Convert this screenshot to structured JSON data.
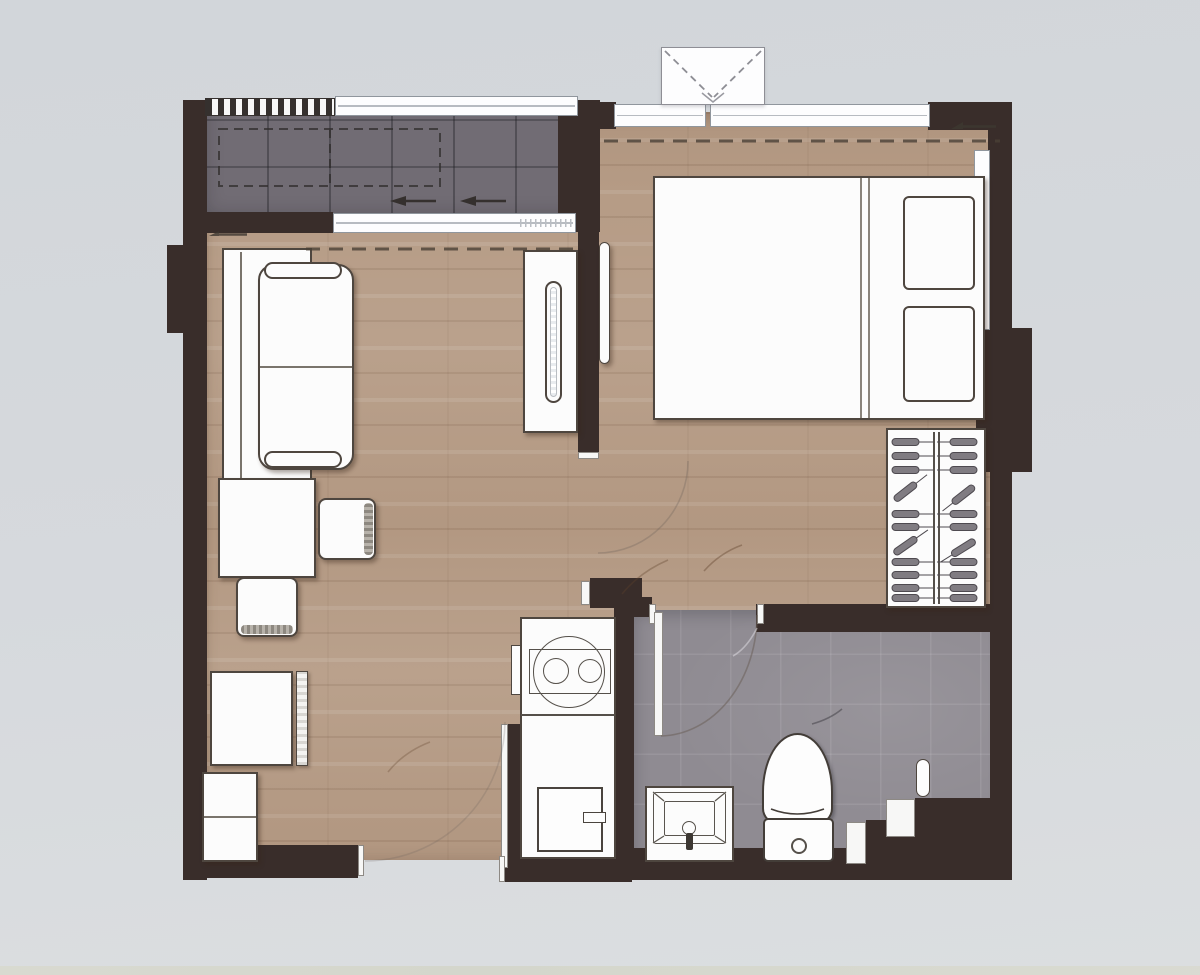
{
  "title": "One-bedroom apartment floor plan (top-down architectural drawing, no legible text labels)",
  "colors": {
    "background": "#d6d9dd",
    "wall": "#392d2a",
    "wood_floor": "#b69c86",
    "balcony_floor": "#716c74",
    "bathroom_floor": "#8f8b92",
    "furniture_fill": "#fcfcfc",
    "furniture_line": "#4e463f",
    "window_line": "#90969d",
    "hanger_gray": "#807c82",
    "dashed_line": "#4a4036"
  },
  "rooms": {
    "balcony": {
      "label": "Balcony (gray tile, railing, dashed AC-unit outline, slide arrows)"
    },
    "living": {
      "label": "Living / dining room (wood floor)"
    },
    "bedroom": {
      "label": "Bedroom (wood floor, dashed curtain line, level marker)"
    },
    "kitchen": {
      "label": "Kitchenette (counter along corridor)"
    },
    "bathroom": {
      "label": "Bathroom (gray tile, stepped corner niche)"
    }
  },
  "objects": {
    "sofa": {
      "label": "Two-seat sofa"
    },
    "tv_cabinet": {
      "label": "TV sideboard"
    },
    "tv": {
      "label": "TV on sideboard"
    },
    "bedroom_tv": {
      "label": "Bedroom wall TV"
    },
    "dining_table": {
      "label": "Dining table"
    },
    "chair_right": {
      "label": "Dining chair (east)"
    },
    "chair_bottom": {
      "label": "Dining chair (south)"
    },
    "low_cabinet": {
      "label": "Low cabinet with slatted panel"
    },
    "tall_cabinet": {
      "label": "Tall cabinet / refrigerator"
    },
    "bed": {
      "label": "Double bed"
    },
    "pillow_1": {
      "label": "Pillow"
    },
    "pillow_2": {
      "label": "Pillow"
    },
    "wardrobe": {
      "label": "Wardrobe with clothes hangers"
    },
    "counter": {
      "label": "Kitchen counter"
    },
    "stove": {
      "label": "Two-burner stove"
    },
    "kitchen_sink": {
      "label": "Square kitchen sink with tap"
    },
    "vanity": {
      "label": "Bathroom vanity basin with faucet"
    },
    "toilet": {
      "label": "Toilet with tank and flush button"
    },
    "shower": {
      "label": "Shower head"
    },
    "niche": {
      "label": "Wall niche"
    },
    "ac_unit": {
      "label": "Outdoor air-conditioner condenser (dashed cross)"
    },
    "sliding_door": {
      "label": "Balcony sliding glass door"
    },
    "bathroom_door": {
      "label": "Bathroom door with swing arc"
    },
    "bedroom_door": {
      "label": "Bedroom doorway swing arc"
    },
    "entrance": {
      "label": "Entrance opening in bottom wall"
    },
    "railing": {
      "label": "Balcony railing (hatched)"
    },
    "window_top": {
      "label": "Bedroom window band"
    },
    "level_marker": {
      "label": "Small level-marker annotation (illegible)"
    }
  }
}
